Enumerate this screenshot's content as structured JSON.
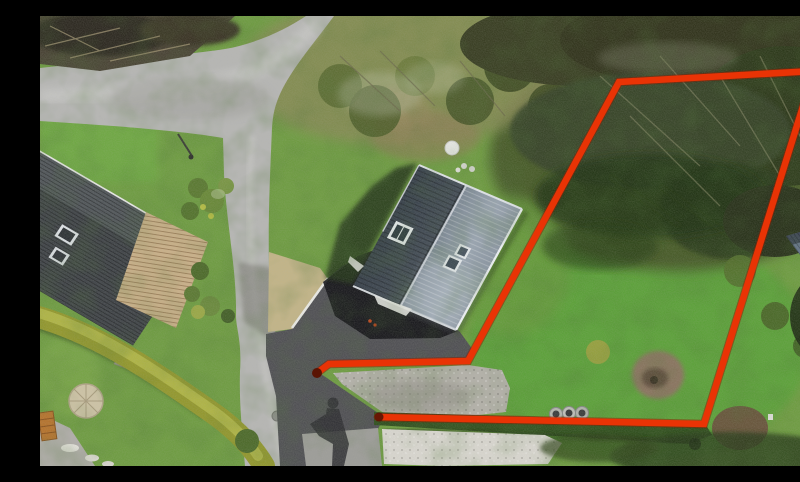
{
  "image": {
    "kind": "aerial-drone-photograph",
    "description": "Aerial drone view of a residential plot: modern house with two-tone gabled roof and dark asphalt driveway, neighbouring house with dark tiled roof at lower left, curving grey roads, yellow and dark clipped hedges, lawns and trees. A thick red outline annotates the boundary of the adjoining grass parcel on the right, open at the driveway entrance, with a dark vertex dot.",
    "width_px": 800,
    "height_px": 450
  },
  "boundary": {
    "color": "#e93305",
    "underlay_color": "#8e1d02",
    "stroke_width": "6.5",
    "underlay_width": "8.5",
    "points": "277,357 289,348 428,345 579,66 774,55 664,408 338,401",
    "dot_color": "#5a1404",
    "dot_start": {
      "cx": "277",
      "cy": "357",
      "r": "5"
    },
    "dot_end": {
      "cx": "339",
      "cy": "401",
      "r": "4.5"
    }
  },
  "palette": {
    "grass": "#6f9c43",
    "parcel_lawn": "#5da23b",
    "road": "#b6b6b4",
    "driveway": "#515155",
    "house_shadow": "#17171b",
    "roof_dark_face": "#3f4852",
    "roof_light_face": "#8c97a3",
    "neighbor_roof": "#42464a",
    "shed_roof": "#66748c",
    "hedge_yellow": "#93982f",
    "hedge_dark": "#31501f",
    "gravel": "#b3b1a9",
    "white_gravel": "#d8d6cf",
    "deck": "#c9b089",
    "dry_grass": "#c2b488",
    "dirt_mound": "#8a7460",
    "stone_circle": "#cdc3a6",
    "crate": "#b5742f"
  },
  "landmarks": [
    {
      "name": "main-house",
      "cx": 398,
      "cy": 232
    },
    {
      "name": "neighbor-house",
      "cx": 60,
      "cy": 240
    },
    {
      "name": "garden-shed",
      "cx": 775,
      "cy": 247
    },
    {
      "name": "outlined-parcel",
      "cx": 640,
      "cy": 230
    },
    {
      "name": "road-junction",
      "cx": 160,
      "cy": 75
    },
    {
      "name": "driveway",
      "cx": 330,
      "cy": 310
    },
    {
      "name": "drone-pilot-shadow",
      "cx": 293,
      "cy": 415
    },
    {
      "name": "concrete-well-rings",
      "cx": 529,
      "cy": 397
    },
    {
      "name": "dirt-mound",
      "cx": 618,
      "cy": 360
    },
    {
      "name": "garden-table",
      "cx": 412,
      "cy": 132
    },
    {
      "name": "stone-patio-circle",
      "cx": 46,
      "cy": 385
    },
    {
      "name": "yellow-hedge",
      "cx": 110,
      "cy": 370
    }
  ]
}
